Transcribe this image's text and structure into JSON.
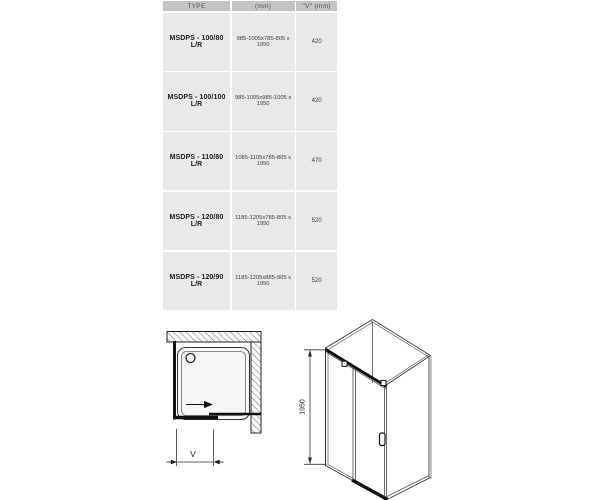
{
  "table": {
    "headers": [
      "TYPE",
      "(mm)",
      "\"V\" (mm)"
    ],
    "rows": [
      {
        "type": "MSDPS - 100/80 L/R",
        "dimensions": "985-1005x785-805 x 1950",
        "v": "420"
      },
      {
        "type": "MSDPS - 100/100 L/R",
        "dimensions": "985-1005x985-1005 x 1950",
        "v": "420"
      },
      {
        "type": "MSDPS - 110/80 L/R",
        "dimensions": "1085-1105x785-805 x 1950",
        "v": "470"
      },
      {
        "type": "MSDPS - 120/80 L/R",
        "dimensions": "1185-1205x785-805 x 1950",
        "v": "520"
      },
      {
        "type": "MSDPS - 120/90 L/R",
        "dimensions": "1185-1205x885-905 x 1950",
        "v": "520"
      }
    ],
    "colors": {
      "header_bg": "#c4c4c4",
      "row_bg": "#e9e9e9",
      "separator": "#ffffff"
    }
  },
  "diagrams": {
    "plan_view": {
      "dimension_label": "V"
    },
    "side_view": {
      "height_label": "1950"
    },
    "colors": {
      "line": "#1a1a1a",
      "thin_line": "#4a4a4a"
    }
  }
}
